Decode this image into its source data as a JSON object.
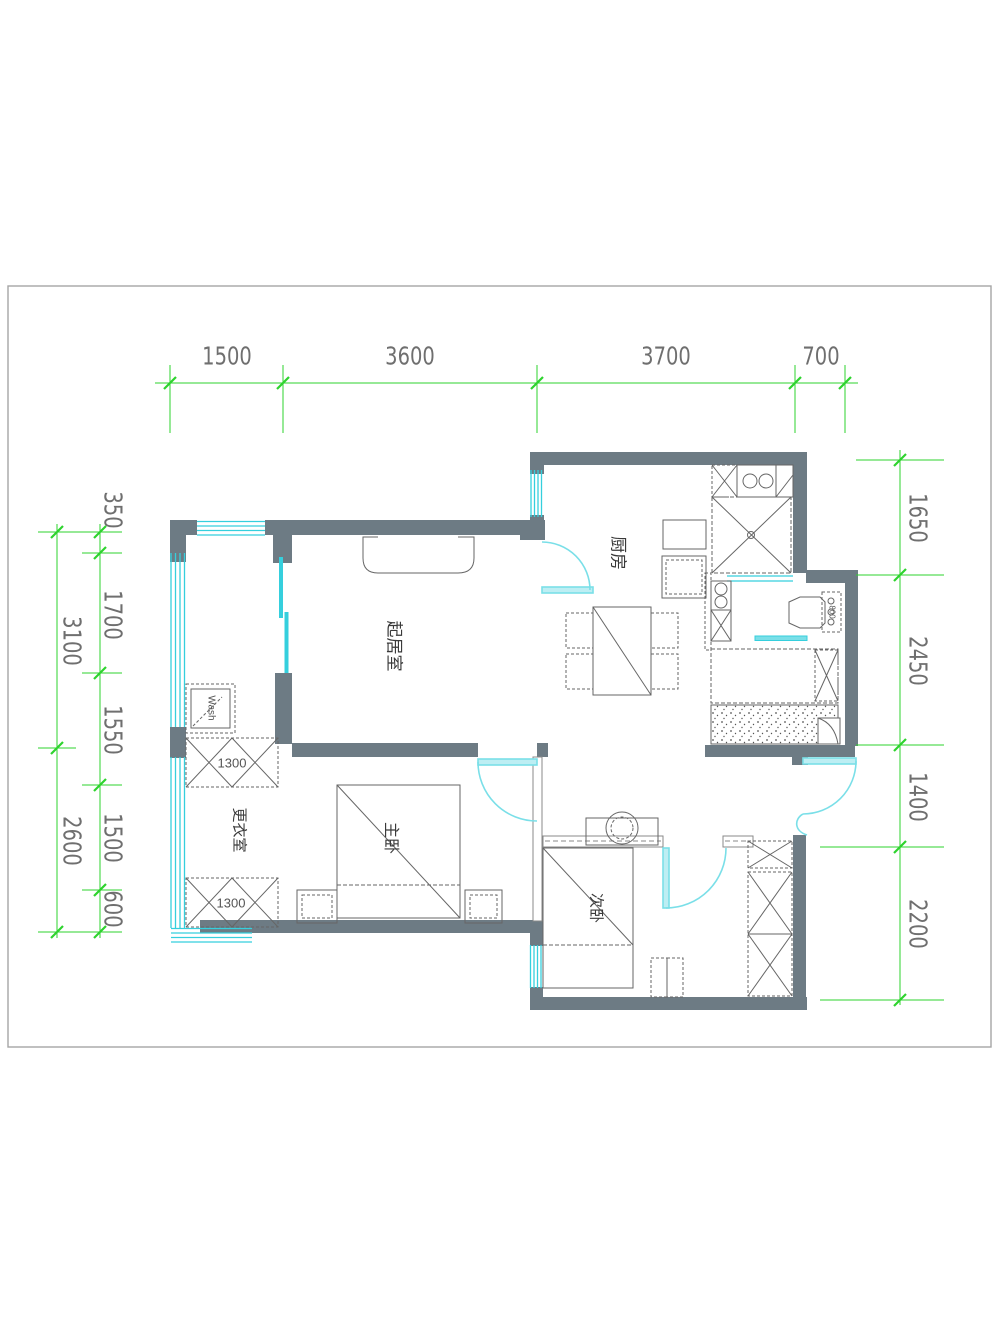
{
  "drawing": {
    "title": "apartment-floor-plan",
    "rooms": [
      {
        "id": "kitchen",
        "label": "厨房"
      },
      {
        "id": "living",
        "label": "起居室"
      },
      {
        "id": "master",
        "label": "主卧"
      },
      {
        "id": "dressing",
        "label": "更衣室"
      },
      {
        "id": "second",
        "label": "次卧"
      }
    ],
    "fixtures": {
      "washer_label": "Wash",
      "wardrobe_top_label": "1300",
      "wardrobe_bottom_label": "1300",
      "toilet_tank_label": "800"
    },
    "dimensions": {
      "top": [
        "1500",
        "3600",
        "3700",
        "700"
      ],
      "left_outer": [
        "3100",
        "2600"
      ],
      "left_inner": [
        "350",
        "1700",
        "1550",
        "1500",
        "600"
      ],
      "right": [
        "1650",
        "2450",
        "1400",
        "2200"
      ]
    },
    "colors": {
      "wall": "#6d7b84",
      "window": "#35cfdd",
      "door": "#7adfe8",
      "dimension": "#2ed32e",
      "linework": "#666666"
    }
  }
}
